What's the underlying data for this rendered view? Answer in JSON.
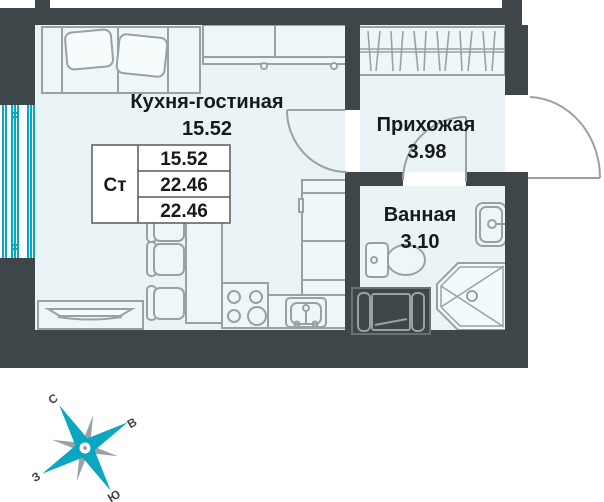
{
  "plan": {
    "title": "Studio apartment floor plan",
    "rooms": [
      {
        "name": "Кухня-гостиная",
        "area": "15.52"
      },
      {
        "name": "Прихожая",
        "area": "3.98"
      },
      {
        "name": "Ванная",
        "area": "3.10"
      }
    ],
    "area_table": {
      "type": "Ст",
      "rows": [
        "15.52",
        "22.46",
        "22.46"
      ]
    },
    "compass": {
      "n": "С",
      "e": "В",
      "w": "З",
      "s": "Ю"
    },
    "colors": {
      "wall": "#3f464a",
      "floor": "#eaf4f7",
      "outline": "#9aa1a5",
      "accent": "#0ba7c0",
      "text": "#17191b"
    }
  }
}
